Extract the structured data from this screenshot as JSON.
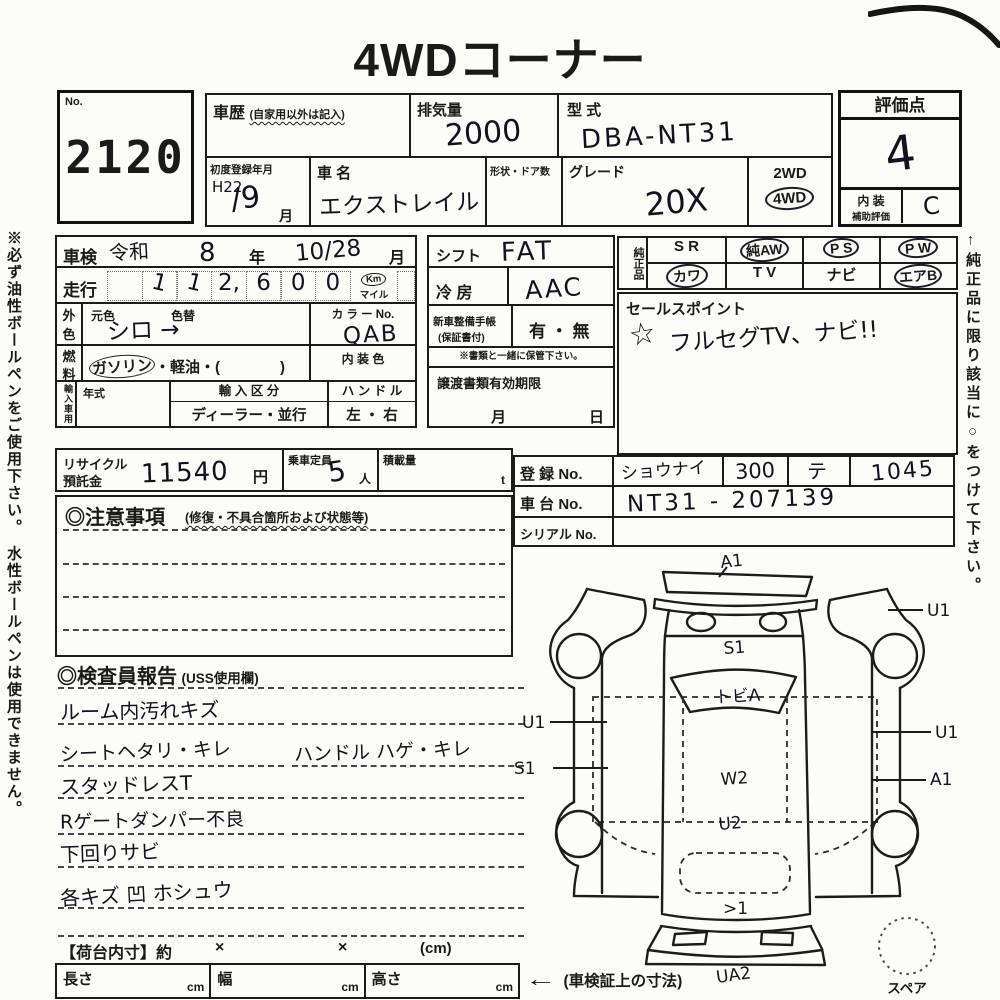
{
  "title": "4WDコーナー",
  "margin_notes": {
    "left": "※必ず油性ボールペンをご使用下さい。　水性ボールペンは使用できません。",
    "right": "←純正品に限り該当に○をつけて下さい。"
  },
  "lot": {
    "label": "No.",
    "number": "2120"
  },
  "header": {
    "history_label": "車歴",
    "history_note": "(自家用以外は記入)",
    "displacement_label": "排気量",
    "displacement_value": "2000",
    "model_code_label": "型 式",
    "model_code_value": "DBA-NT31",
    "first_reg_label": "初度登録年月",
    "first_reg_year": "H22",
    "first_reg_month": "/9",
    "month_unit": "月",
    "car_name_label": "車 名",
    "car_name_value": "エクストレイル",
    "shape_doors_label": "形状・ドア数",
    "grade_label": "グレード",
    "grade_value": "20X",
    "drive_2wd": "2WD",
    "drive_4wd": "4WD"
  },
  "evaluation": {
    "title": "評価点",
    "score": "4",
    "interior_label_top": "内 装",
    "interior_label_bottom": "補助評価",
    "interior_grade": "C"
  },
  "inspection": {
    "shaken_label": "車検",
    "shaken_era": "令和",
    "shaken_year": "8",
    "year_unit": "年",
    "shaken_date": "10/28",
    "month_unit": "月",
    "mileage_label": "走行",
    "mileage_cells": [
      "",
      "1",
      "1",
      "2,",
      "6",
      "0",
      "0"
    ],
    "unit_km": "Km",
    "unit_mile": "マイル",
    "color_label": "外色",
    "orig_color_label": "元色",
    "repaint_label": "色替",
    "color_value": "シロ →",
    "color_no_label": "カ ラ ー No.",
    "color_no_value": "QAB",
    "fuel_label": "燃料",
    "fuel_gasoline": "ガソリン",
    "fuel_rest": "・軽油・(　　　　)",
    "interior_color_label": "内 装 色",
    "import_label": "輸入車用",
    "year_model_label": "年式",
    "import_class_label": "輸 入 区 分",
    "import_class_value": "ディーラー・並行",
    "handle_label": "ハ ン ド ル",
    "handle_value": "左 ・ 右"
  },
  "middle": {
    "shift_label": "シフト",
    "shift_value": "FAT",
    "ac_label": "冷 房",
    "ac_value": "AAC",
    "warranty_label": "新車整備手帳",
    "warranty_label2": "(保証書付)",
    "warranty_value": "有 ・ 無",
    "warranty_note": "※書類と一緒に保管下さい。",
    "transfer_label": "譲渡書類有効期限",
    "transfer_month": "月",
    "transfer_day": "日"
  },
  "genuine": {
    "label": "純正品",
    "items": [
      {
        "text": "S R",
        "circled": false
      },
      {
        "text": "純AW",
        "circled": true
      },
      {
        "text": "P S",
        "circled": true
      },
      {
        "text": "P W",
        "circled": true
      },
      {
        "text": "カワ",
        "circled": true
      },
      {
        "text": "T V",
        "circled": false
      },
      {
        "text": "ナビ",
        "circled": false
      },
      {
        "text": "エアB",
        "circled": true
      }
    ]
  },
  "sales_point": {
    "label": "セールスポイント",
    "star": "☆",
    "value": "フルセグTV、ナビ!!"
  },
  "capacity": {
    "recycle_label": "リサイクル",
    "recycle_label2": "預託金",
    "recycle_value": "11540",
    "yen": "円",
    "seats_label": "乗車定員",
    "seats_value": "5",
    "seats_unit": "人",
    "load_label": "積載量",
    "load_unit": "t"
  },
  "registration": {
    "reg_label": "登 録 No.",
    "reg_area": "ショウナイ",
    "reg_class": "300",
    "reg_kana": "テ",
    "reg_number": "1045",
    "chassis_label": "車 台 No.",
    "chassis_value": "NT31 - 207139",
    "serial_label": "シリアル No."
  },
  "cautions": {
    "title": "◎注意事項",
    "subtitle": "(修復・不具合箇所および状態等)"
  },
  "inspector": {
    "title": "◎検査員報告",
    "subtitle": "(USS使用欄)",
    "lines": [
      {
        "left": "ルーム内汚れキズ",
        "right": ""
      },
      {
        "left": "シートヘタリ・キレ",
        "right": "ハンドル ハゲ・キレ"
      },
      {
        "left": "スタッドレスT",
        "right": ""
      },
      {
        "left": "Rゲートダンパー不良",
        "right": ""
      },
      {
        "left": "下回りサビ",
        "right": ""
      },
      {
        "left": "各キズ 凹 ホシュウ",
        "right": ""
      }
    ]
  },
  "diagram": {
    "labels": {
      "front": "A1",
      "right_fender": "U1",
      "hood": "S1",
      "windshield": "トビA",
      "left_door_upper": "U1",
      "left_door_lower": "S1",
      "right_door_upper": "U1",
      "right_door_lower": "A1",
      "roof": "W2",
      "cargo_floor": "U2",
      "rear_gate": ">1",
      "rear_under": "UA2"
    },
    "spare_label": "スペア"
  },
  "cargo_dims": {
    "label": "【荷台内寸】約",
    "times1": "×",
    "times2": "×",
    "unit": "(cm)",
    "length_label": "長さ",
    "width_label": "幅",
    "height_label": "高さ",
    "cm1": "cm",
    "cm2": "cm",
    "cm3": "cm",
    "arrow": "←",
    "note": "(車検証上の寸法)"
  }
}
